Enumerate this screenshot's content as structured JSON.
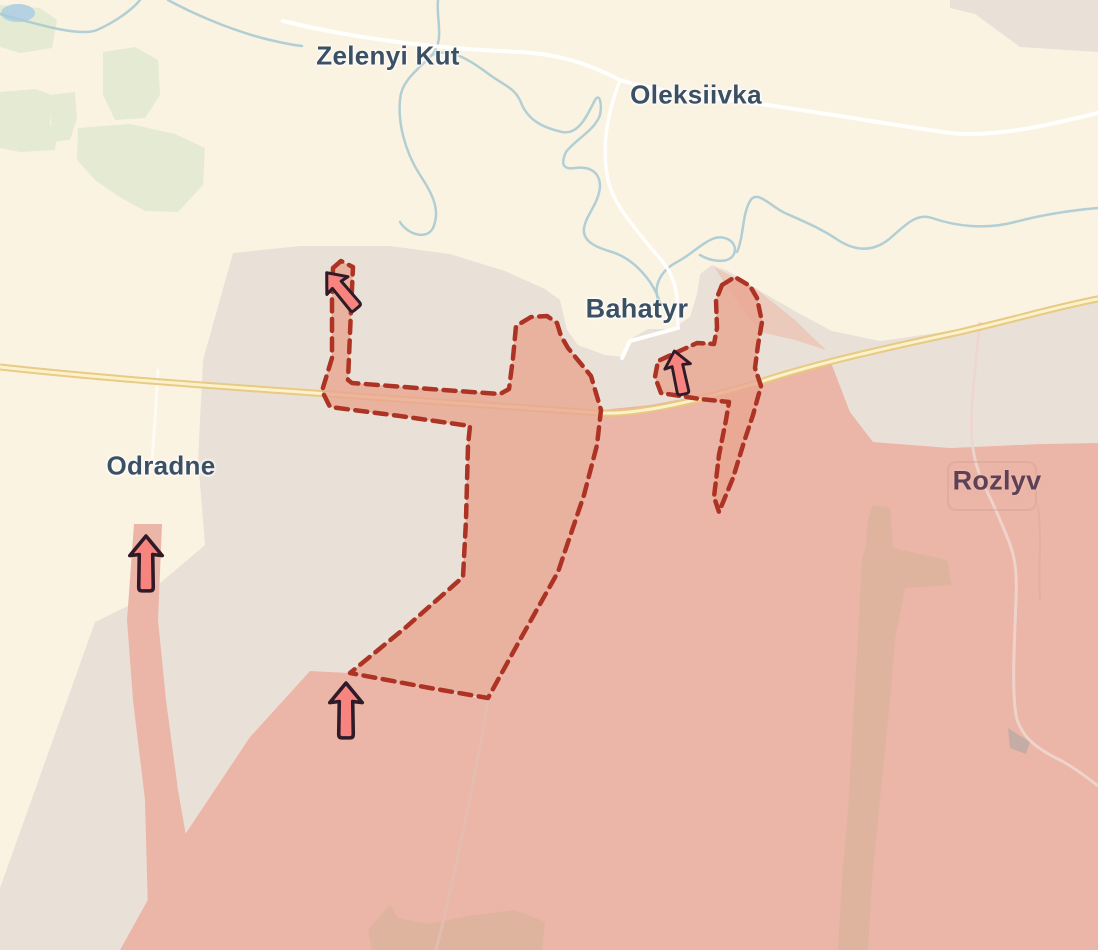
{
  "map": {
    "place_labels": [
      {
        "id": "zelenyi-kut",
        "name": "Zelenyi Kut"
      },
      {
        "id": "oleksiivka",
        "name": "Oleksiivka"
      },
      {
        "id": "bahatyr",
        "name": "Bahatyr"
      },
      {
        "id": "odradne",
        "name": "Odradne"
      },
      {
        "id": "rozlyv",
        "name": "Rozlyv"
      }
    ],
    "zones": [
      {
        "id": "fields",
        "color": "#fbf3e1"
      },
      {
        "id": "forest",
        "color": "#e4ebd2"
      },
      {
        "id": "water",
        "color": "#a9cbd4"
      },
      {
        "id": "grey-zone",
        "color": "#e9e1d8"
      },
      {
        "id": "occupied-area",
        "color": "#ebb5a7"
      },
      {
        "id": "contested-advance",
        "fill": "#eec0b0",
        "stripe": "#b04531",
        "border": "#ad3424"
      }
    ],
    "roads": {
      "highway_color": "#e7c87e",
      "local_road_color": "#ffffff"
    },
    "markers": [
      {
        "icon": "advance-arrow-icon",
        "color": "#f8847f",
        "outline": "#2f1b28",
        "direction": "north-west"
      },
      {
        "icon": "advance-arrow-icon",
        "color": "#f8847f",
        "outline": "#2f1b28",
        "direction": "north"
      },
      {
        "icon": "advance-arrow-icon",
        "color": "#f8847f",
        "outline": "#2f1b28",
        "direction": "north"
      },
      {
        "icon": "advance-arrow-icon",
        "color": "#f8847f",
        "outline": "#2f1b28",
        "direction": "north"
      }
    ]
  }
}
